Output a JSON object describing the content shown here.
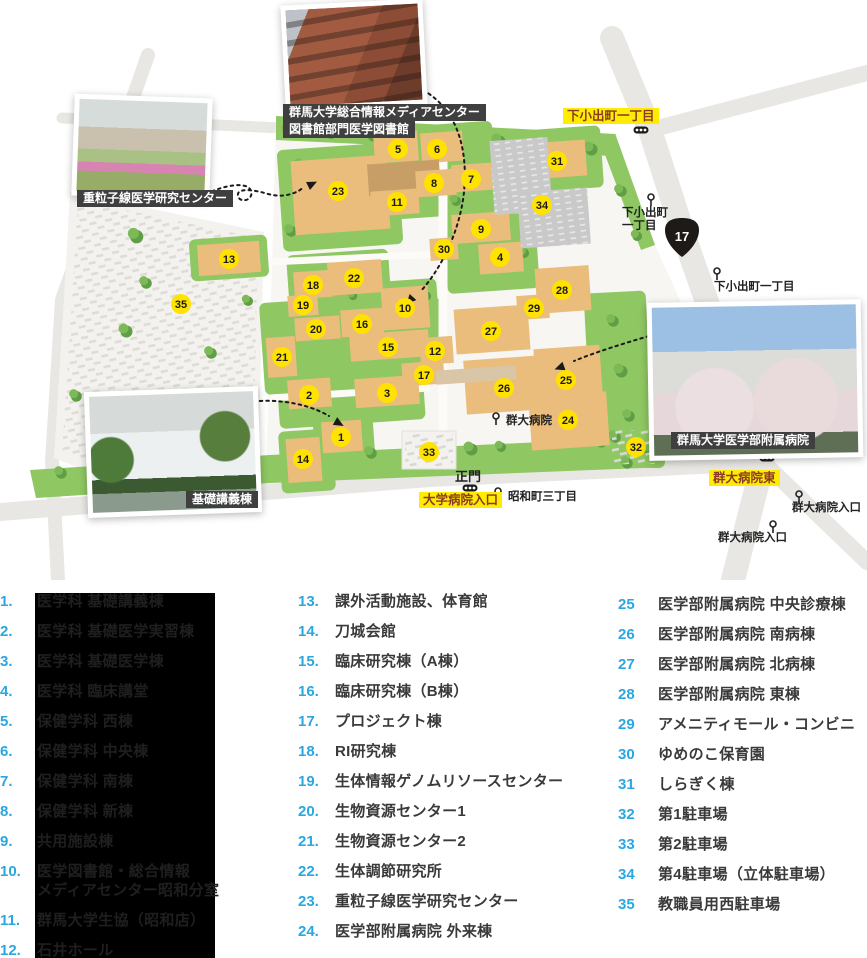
{
  "map": {
    "colors": {
      "building": "#eabd7c",
      "building_dark": "#c79e66",
      "gray_building": "#c9c9c9",
      "green": "#8fc763",
      "tree": "#5f9e45",
      "road": "#e8e7e3",
      "marker_bg": "#ffe200",
      "marker_text": "#1a1a1a",
      "highlight_bg": "#ffec00",
      "highlight_text": "#8a3a28",
      "caption_bg": "#3f3f3f",
      "caption_text": "#ffffff"
    },
    "route_shield": {
      "number": "17",
      "x": 682,
      "y": 237
    },
    "markers": [
      {
        "n": "1",
        "x": 341,
        "y": 437
      },
      {
        "n": "2",
        "x": 309,
        "y": 395
      },
      {
        "n": "3",
        "x": 387,
        "y": 393
      },
      {
        "n": "4",
        "x": 500,
        "y": 257
      },
      {
        "n": "5",
        "x": 398,
        "y": 149
      },
      {
        "n": "6",
        "x": 437,
        "y": 149
      },
      {
        "n": "7",
        "x": 471,
        "y": 179
      },
      {
        "n": "8",
        "x": 434,
        "y": 183
      },
      {
        "n": "9",
        "x": 481,
        "y": 229
      },
      {
        "n": "10",
        "x": 405,
        "y": 308
      },
      {
        "n": "11",
        "x": 397,
        "y": 202
      },
      {
        "n": "12",
        "x": 435,
        "y": 351
      },
      {
        "n": "13",
        "x": 229,
        "y": 259
      },
      {
        "n": "14",
        "x": 303,
        "y": 459
      },
      {
        "n": "15",
        "x": 388,
        "y": 347
      },
      {
        "n": "16",
        "x": 362,
        "y": 324
      },
      {
        "n": "17",
        "x": 424,
        "y": 375
      },
      {
        "n": "18",
        "x": 313,
        "y": 285
      },
      {
        "n": "19",
        "x": 303,
        "y": 305
      },
      {
        "n": "20",
        "x": 316,
        "y": 329
      },
      {
        "n": "21",
        "x": 282,
        "y": 357
      },
      {
        "n": "22",
        "x": 354,
        "y": 278
      },
      {
        "n": "23",
        "x": 338,
        "y": 191
      },
      {
        "n": "24",
        "x": 568,
        "y": 420
      },
      {
        "n": "25",
        "x": 566,
        "y": 380
      },
      {
        "n": "26",
        "x": 504,
        "y": 388
      },
      {
        "n": "27",
        "x": 491,
        "y": 331
      },
      {
        "n": "28",
        "x": 562,
        "y": 290
      },
      {
        "n": "29",
        "x": 534,
        "y": 308
      },
      {
        "n": "30",
        "x": 444,
        "y": 249
      },
      {
        "n": "31",
        "x": 557,
        "y": 161
      },
      {
        "n": "32",
        "x": 636,
        "y": 447
      },
      {
        "n": "33",
        "x": 429,
        "y": 452
      },
      {
        "n": "34",
        "x": 542,
        "y": 205
      },
      {
        "n": "35",
        "x": 181,
        "y": 304
      }
    ],
    "stops": [
      {
        "text": "下小出町\n一丁目",
        "x": 622,
        "y": 216,
        "ix": 651,
        "iy": 197
      },
      {
        "text": "下小出町一丁目",
        "x": 714,
        "y": 290,
        "ix": 717,
        "iy": 271
      },
      {
        "text": "群大病院",
        "x": 506,
        "y": 424,
        "ix": 496,
        "iy": 416
      },
      {
        "text": "昭和町三丁目",
        "x": 508,
        "y": 500,
        "ix": 498,
        "iy": 491
      },
      {
        "text": "群大病院入口",
        "x": 792,
        "y": 511,
        "ix": 799,
        "iy": 494
      },
      {
        "text": "群大病院入口",
        "x": 718,
        "y": 541,
        "ix": 773,
        "iy": 524
      },
      {
        "text": "正門",
        "x": 455,
        "y": 481,
        "gate": true
      }
    ],
    "traffic_lights": [
      [
        641,
        130
      ],
      [
        470,
        488
      ],
      [
        767,
        458
      ]
    ],
    "road_labels": [
      {
        "text": "下小出町一丁目",
        "x": 563,
        "y": 108
      },
      {
        "text": "大学病院入口",
        "x": 419,
        "y": 492
      },
      {
        "text": "群大病院東",
        "x": 709,
        "y": 470
      }
    ],
    "photo_captions": [
      {
        "text": "群馬大学総合情報メディアセンター",
        "x": 283,
        "y": 104
      },
      {
        "text": "図書館部門医学図書館",
        "x": 283,
        "y": 121
      },
      {
        "text": "重粒子線医学研究センター",
        "x": 77,
        "y": 190
      },
      {
        "text": "群馬大学医学部附属病院",
        "x": 671,
        "y": 432
      },
      {
        "text": "基礎講義棟",
        "x": 186,
        "y": 491
      }
    ]
  },
  "legend": {
    "columns": [
      {
        "items": [
          {
            "num": "1.",
            "label": "医学科 基礎講義棟"
          },
          {
            "num": "2.",
            "label": "医学科 基礎医学実習棟"
          },
          {
            "num": "3.",
            "label": "医学科 基礎医学棟"
          },
          {
            "num": "4.",
            "label": "医学科 臨床講堂"
          },
          {
            "num": "5.",
            "label": "保健学科 西棟"
          },
          {
            "num": "6.",
            "label": "保健学科 中央棟"
          },
          {
            "num": "7.",
            "label": "保健学科 南棟"
          },
          {
            "num": "8.",
            "label": "保健学科 新棟"
          },
          {
            "num": "9.",
            "label": "共用施設棟"
          },
          {
            "num": "10.",
            "label": "医学図書館・総合情報\nメディアセンター昭和分室"
          },
          {
            "num": "11.",
            "label": "群馬大学生協（昭和店）"
          },
          {
            "num": "12.",
            "label": "石井ホール"
          }
        ]
      },
      {
        "items": [
          {
            "num": "13.",
            "label": "課外活動施設、体育館"
          },
          {
            "num": "14.",
            "label": "刀城会館"
          },
          {
            "num": "15.",
            "label": "臨床研究棟（A棟）"
          },
          {
            "num": "16.",
            "label": "臨床研究棟（B棟）"
          },
          {
            "num": "17.",
            "label": "プロジェクト棟"
          },
          {
            "num": "18.",
            "label": "RI研究棟"
          },
          {
            "num": "19.",
            "label": "生体情報ゲノムリソースセンター"
          },
          {
            "num": "20.",
            "label": "生物資源センター1"
          },
          {
            "num": "21.",
            "label": "生物資源センター2"
          },
          {
            "num": "22.",
            "label": "生体調節研究所"
          },
          {
            "num": "23.",
            "label": "重粒子線医学研究センター"
          },
          {
            "num": "24.",
            "label": "医学部附属病院 外来棟"
          }
        ]
      },
      {
        "items": [
          {
            "num": "25",
            "label": "医学部附属病院 中央診療棟"
          },
          {
            "num": "26",
            "label": "医学部附属病院 南病棟"
          },
          {
            "num": "27",
            "label": "医学部附属病院 北病棟"
          },
          {
            "num": "28",
            "label": "医学部附属病院 東棟"
          },
          {
            "num": "29",
            "label": "アメニティモール・コンビニ"
          },
          {
            "num": "30",
            "label": "ゆめのこ保育園"
          },
          {
            "num": "31",
            "label": "しらぎく棟"
          },
          {
            "num": "32",
            "label": "第1駐車場"
          },
          {
            "num": "33",
            "label": "第2駐車場"
          },
          {
            "num": "34",
            "label": "第4駐車場（立体駐車場）"
          },
          {
            "num": "35",
            "label": "教職員用西駐車場"
          }
        ]
      }
    ]
  }
}
